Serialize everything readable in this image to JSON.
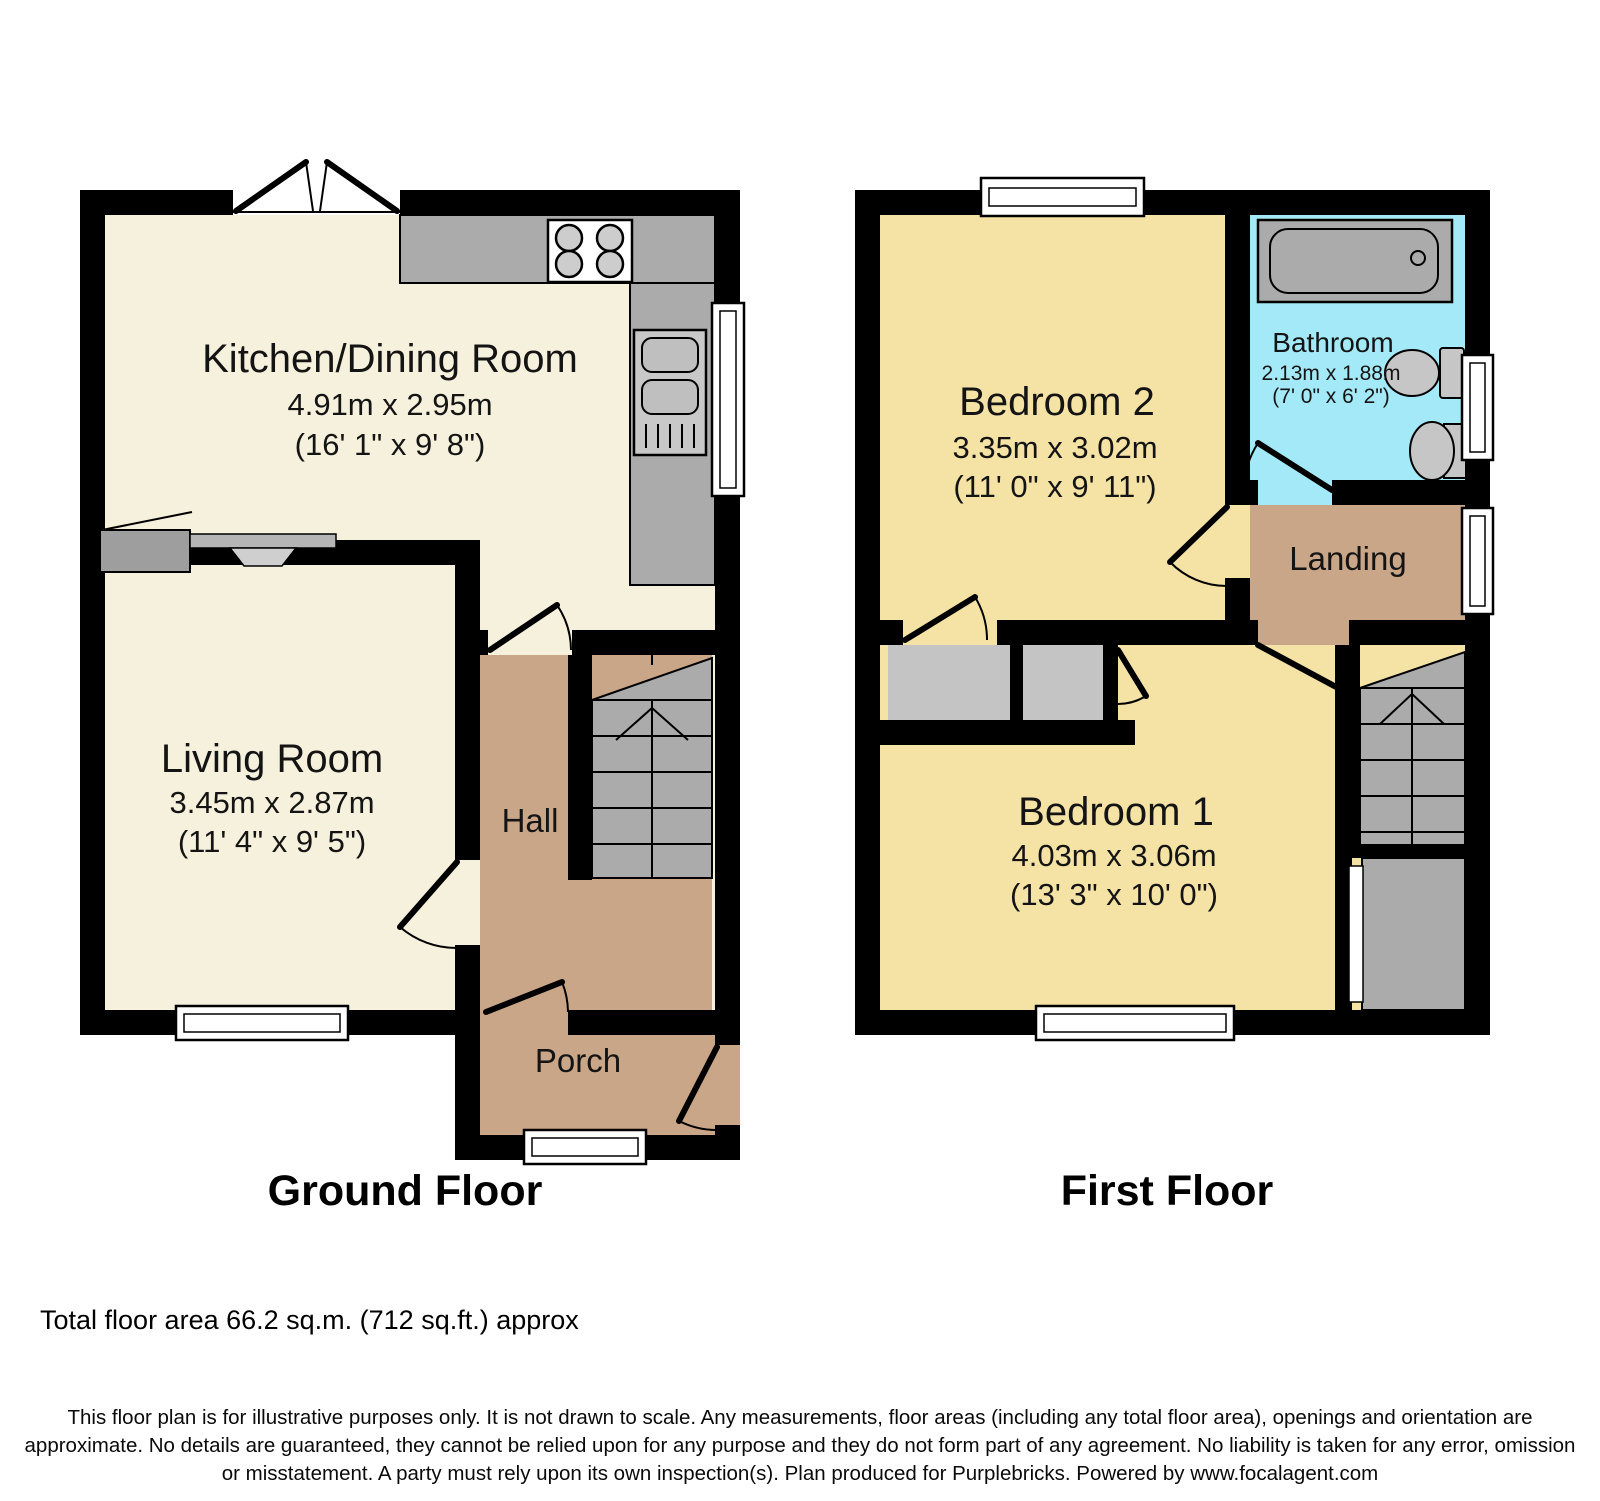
{
  "ground_floor": {
    "caption": "Ground Floor",
    "kitchen": {
      "name": "Kitchen/Dining Room",
      "dims_m": "4.91m x 2.95m",
      "dims_ft": "(16' 1\" x 9' 8\")"
    },
    "living": {
      "name": "Living Room",
      "dims_m": "3.45m x 2.87m",
      "dims_ft": "(11' 4\" x 9' 5\")"
    },
    "hall": {
      "name": "Hall"
    },
    "porch": {
      "name": "Porch"
    }
  },
  "first_floor": {
    "caption": "First Floor",
    "bedroom2": {
      "name": "Bedroom 2",
      "dims_m": "3.35m x 3.02m",
      "dims_ft": "(11' 0\" x 9' 11\")"
    },
    "bathroom": {
      "name": "Bathroom",
      "dims_m": "2.13m x 1.88m",
      "dims_ft": "(7' 0\" x 6' 2\")"
    },
    "landing": {
      "name": "Landing"
    },
    "bedroom1": {
      "name": "Bedroom 1",
      "dims_m": "4.03m x 3.06m",
      "dims_ft": "(13' 3\" x 10' 0\")"
    }
  },
  "summary": {
    "total_area": "Total floor area 66.2 sq.m. (712 sq.ft.) approx"
  },
  "disclaimer": "This floor plan is for illustrative purposes only. It is not drawn to scale. Any measurements, floor areas (including any total floor area), openings and orientation are approximate. No details are guaranteed, they cannot be relied upon for any purpose and they do not form part of any agreement. No liability is taken for any error, omission or misstatement. A party must rely upon its own inspection(s). Plan produced for Purplebricks. Powered by www.focalagent.com",
  "colors": {
    "wall": "#000000",
    "room_cream": "#F6F1DC",
    "room_yellow": "#F5E3A6",
    "hall_tan": "#C9A687",
    "bathroom_blue": "#A4E9F7",
    "fixture_gray": "#ABABAB",
    "background": "#FFFFFF"
  },
  "fixtures": {
    "ground": [
      "french-doors",
      "hob",
      "kitchen-counter",
      "sink-unit",
      "fireplace",
      "stairs-up",
      "windows",
      "door-swings"
    ],
    "first": [
      "bathtub",
      "toilet",
      "wash-basin",
      "wardrobes",
      "stairs",
      "cupboard",
      "windows",
      "door-swings"
    ]
  }
}
